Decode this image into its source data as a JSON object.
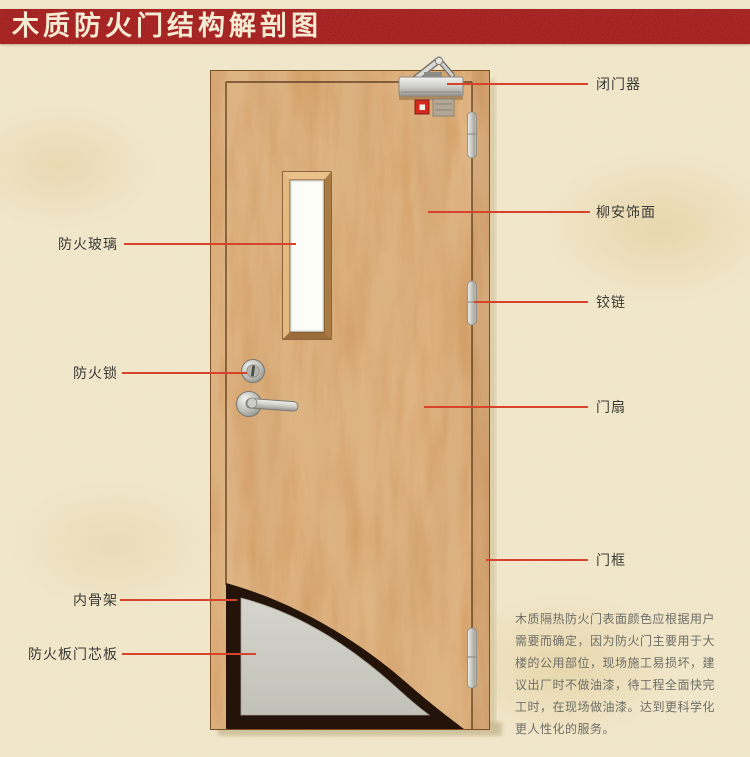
{
  "header": {
    "title": "木质防火门结构解剖图",
    "banner_color": "#9d0d10",
    "title_color": "#f7eed6"
  },
  "labels": {
    "right": [
      {
        "id": "door-closer",
        "text": "闭门器"
      },
      {
        "id": "lauan-veneer",
        "text": "柳安饰面"
      },
      {
        "id": "hinge",
        "text": "铰链"
      },
      {
        "id": "door-leaf",
        "text": "门扇"
      },
      {
        "id": "door-frame",
        "text": "门框"
      }
    ],
    "left": [
      {
        "id": "fire-glass",
        "text": "防火玻璃"
      },
      {
        "id": "fire-lock",
        "text": "防火锁"
      },
      {
        "id": "inner-skeleton",
        "text": "内骨架"
      },
      {
        "id": "fire-core-board",
        "text": "防火板门芯板"
      }
    ]
  },
  "description": {
    "lines": [
      "木质隔热防火门表面颜色应根据用户",
      "需要而确定，因为防火门主要用于大",
      "楼的公用部位，现场施工易损坏，建",
      "议出厂时不做油漆，待工程全面快完",
      "工时，在现场做油漆。达到更科学化",
      "更人性化的服务。"
    ]
  },
  "colors": {
    "leader_line": "#d7432b",
    "wood_base": "#d09156",
    "background": "#f2e8cc",
    "core_panel": "#cccbc3",
    "skeleton_dark": "#241309"
  },
  "diagram_parts": [
    "door-closer",
    "lauan-veneer-face",
    "hinge",
    "door-leaf",
    "door-frame",
    "fire-glass-window",
    "fire-lock",
    "inner-skeleton",
    "fire-board-core-panel"
  ]
}
